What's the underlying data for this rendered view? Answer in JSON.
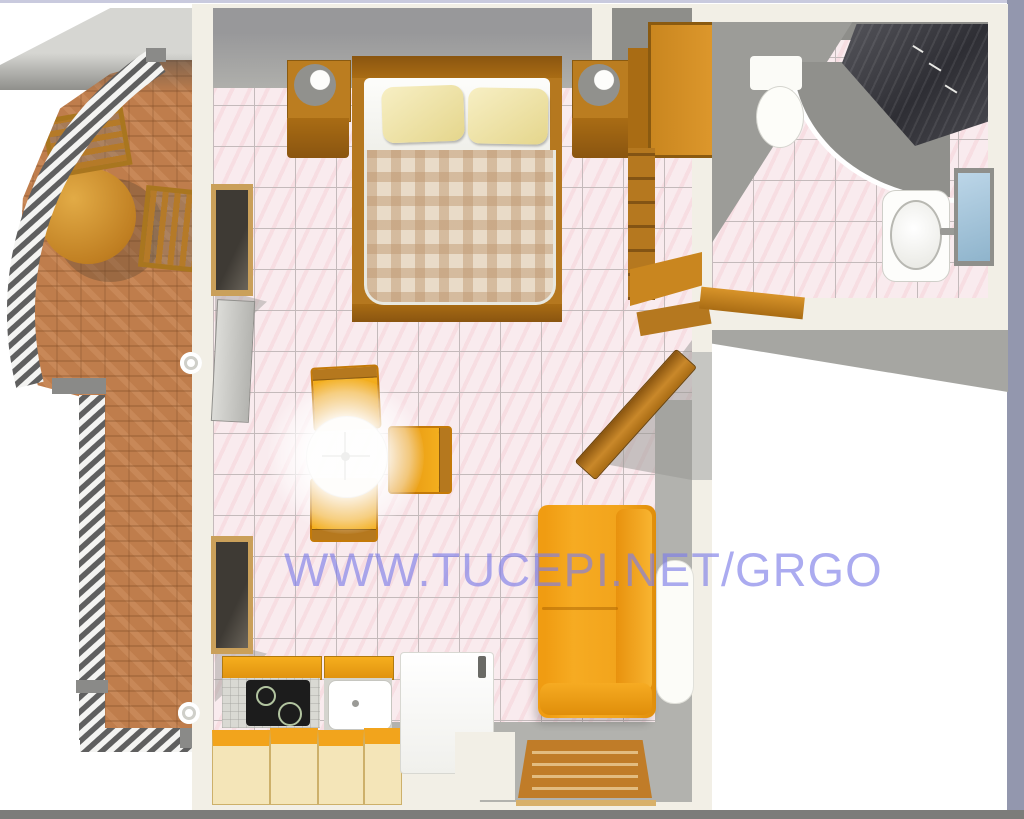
{
  "meta": {
    "type": "3d-floor-plan",
    "description": "Top-down 3D rendered floor plan of a studio apartment with curved balcony, main room and bathroom"
  },
  "watermark": {
    "text": "WWW.TUCEPI.NET/GRGO",
    "color": "#7e7ee8"
  },
  "rooms": {
    "balcony": {
      "label": "balcony",
      "floor": "terracotta-brick",
      "railing": "curved-striped-railing",
      "furniture": [
        "round-wood-table",
        "wood-chair",
        "wood-chair"
      ]
    },
    "main_room": {
      "label": "studio-room",
      "floor": "pink-tiles",
      "furniture": [
        "double-bed",
        "pillow",
        "pillow",
        "nightstand-left",
        "nightstand-right",
        "lamp",
        "lamp",
        "wardrobe",
        "shelf-unit",
        "open-door",
        "dining-table",
        "dining-chair",
        "dining-chair",
        "dining-chair",
        "sofa",
        "radiator",
        "cooktop-unit",
        "sink-unit",
        "refrigerator",
        "kitchen-drawers",
        "doormat",
        "balcony-door",
        "window",
        "window"
      ]
    },
    "bathroom": {
      "label": "bathroom",
      "floor": "pink-tiles",
      "fixtures": [
        "corner-shower",
        "washbasin",
        "toilet",
        "window"
      ]
    }
  },
  "palette": {
    "tile_pink": "#f9ebee",
    "grout": "#c4babb",
    "brick": "#bf7d4c",
    "wood": "#b5781f",
    "orange_furniture": "#f2a41c",
    "cream_cabinet": "#f4e5b8",
    "wall_cream": "#f2efe6",
    "wall_gray": "#a2a29e",
    "shower_dark": "#3a3a40",
    "window_blue": "#a9cbe0",
    "edge_band_right": "#9397ae",
    "edge_band_bottom": "#7c7c7a"
  }
}
